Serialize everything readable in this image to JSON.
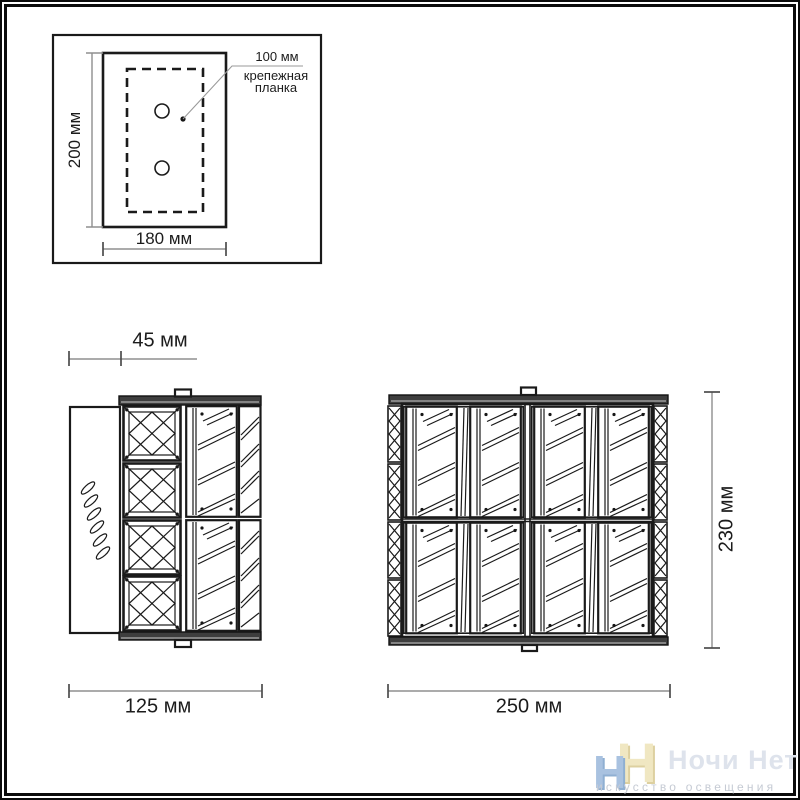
{
  "page": {
    "type": "lighting-fixture-dimension-drawing",
    "background": "#ffffff",
    "border_color": "#0b0b0b",
    "line_color": "#1a1a1a",
    "dim_line_color": "#8f8f8f"
  },
  "mounting_diagram": {
    "height_label": "200 мм",
    "width_label": "180 мм",
    "hole_spacing_label": "100 мм",
    "plate_label_line1": "крепежная",
    "plate_label_line2": "планка"
  },
  "side_view": {
    "depth_label": "45 мм",
    "width_label": "125 мм"
  },
  "front_view": {
    "height_label": "230 мм",
    "width_label": "250 мм"
  },
  "watermark": {
    "monogram_first": "Н",
    "monogram_second": "Н",
    "brand": "Ночи Нет",
    "tagline": "искусство освещения",
    "colors": {
      "monogram_blue": "#a9c2e0",
      "monogram_yellow": "#f0e7c2",
      "brand_text": "#dee3ec",
      "tagline_text": "#c6cbd4"
    }
  }
}
